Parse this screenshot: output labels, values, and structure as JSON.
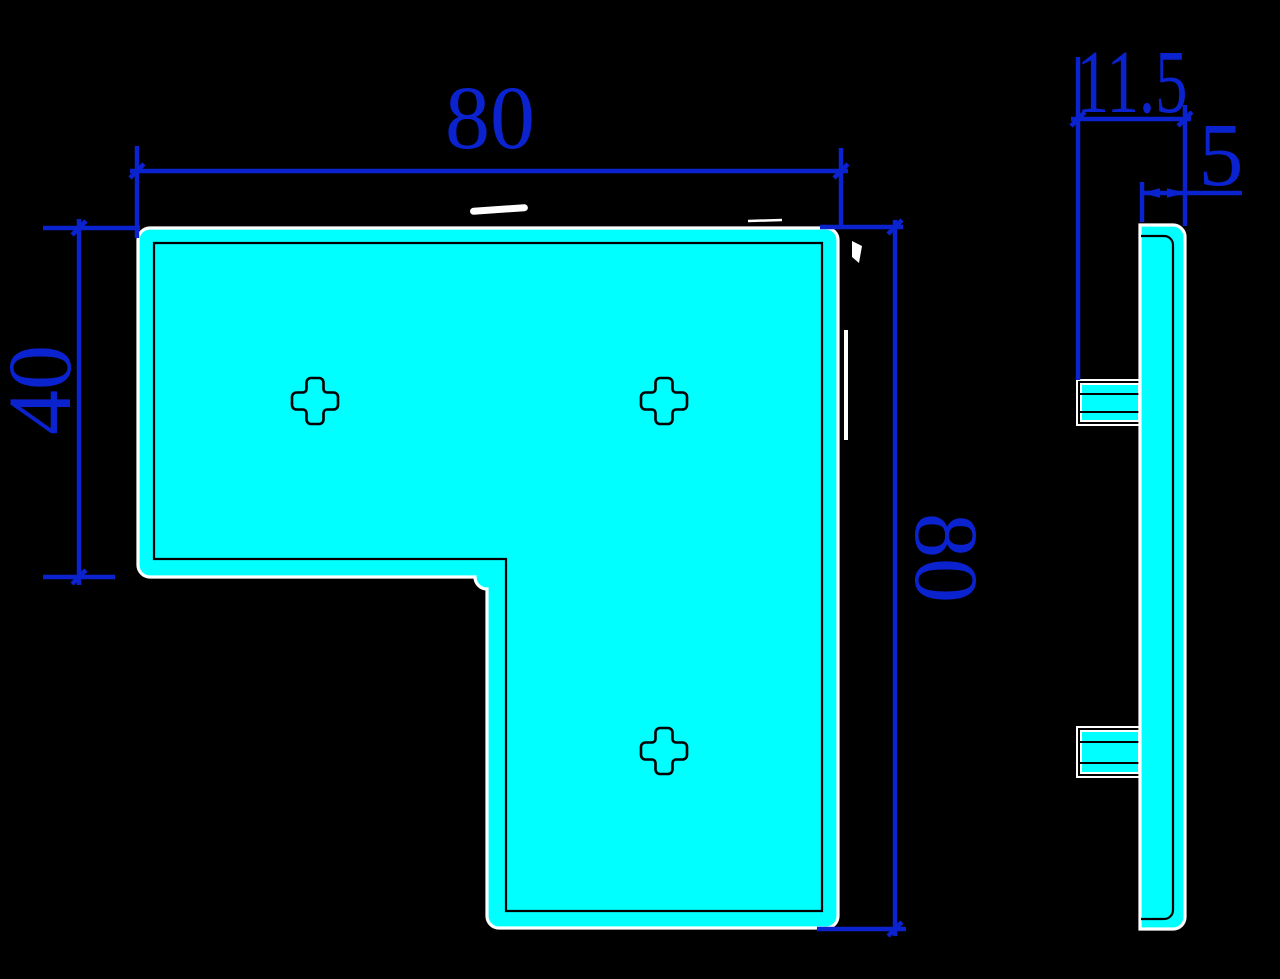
{
  "drawing": {
    "type": "two-view engineering drawing",
    "part": "L-shaped corner bracket plate",
    "views": {
      "front": "L-shaped plate with three cross-shaped holes",
      "side": "plate edge profile with two clip tabs"
    },
    "dimensions": {
      "width_top": "80",
      "notch_height": "40",
      "height_right": "80",
      "depth": "11.5",
      "thickness": "5"
    },
    "colors": {
      "background": "#000000",
      "part_fill": "#00ffff",
      "part_outline": "#ffffff",
      "edge_line": "#000000",
      "dimension_blue": "#0b22cf"
    }
  }
}
